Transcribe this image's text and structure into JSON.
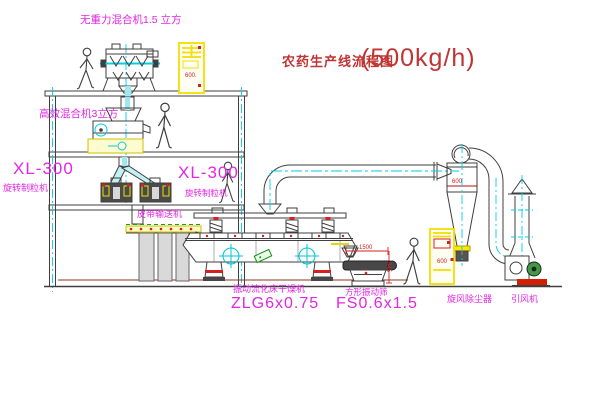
{
  "title": {
    "text": "农药生产线流程图",
    "capacity": "(500kg/h)"
  },
  "equipment_labels": {
    "top_mixer": "无重力混合机1.5 立方",
    "second_mixer": "高效混合机3立方",
    "granulator_left": {
      "model": "XL-300",
      "name": "旋转制粒机"
    },
    "granulator_right": {
      "model": "XL-300",
      "name": "旋转制粒机"
    },
    "belt_conveyor": "皮带输送机",
    "dryer": {
      "name": "振动流化床干燥机",
      "model": "ZLG6x0.75"
    },
    "sieve": {
      "name": "方形振动筛",
      "model": "FS0.6x1.5"
    },
    "cyclone": "旋风除尘器",
    "fan": "引风机"
  },
  "annotations": {
    "cyclone_dim": "600",
    "sieve_width_dim": "1500",
    "sieve_height_dim": "545",
    "packer_panel_text": "600.",
    "cabinet_panel_text": "600"
  },
  "colors": {
    "background": "#ffffff",
    "line": "#3f3f3f",
    "centerline_cyan": "#00cfe0",
    "equipment_yellow": "#f0df00",
    "label_magenta": "#e326e3",
    "dimension_red": "#d42020",
    "title_red": "#c03434",
    "motor_green": "#1a9e1a",
    "ground_maroon": "#8a3a20"
  }
}
